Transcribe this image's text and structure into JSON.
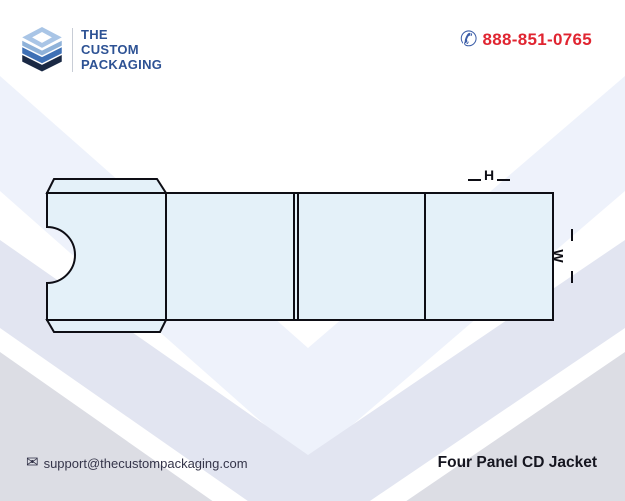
{
  "header": {
    "logo": {
      "lines": [
        "THE",
        "CUSTOM",
        "PACKAGING"
      ]
    },
    "phone": {
      "icon": "✆",
      "number": "888-851-0765"
    }
  },
  "diagram": {
    "height_label": "H",
    "width_label": "W"
  },
  "footer": {
    "email": {
      "icon": "✉",
      "address": "support@thecustompackaging.com"
    },
    "title": "Four Panel CD Jacket"
  },
  "colors": {
    "accent_red": "#e02531",
    "brand_navy": "#2d5294",
    "phone_icon_blue": "#3c5ea8",
    "panel_fill": "#e4f1f9",
    "outline_black": "#0e0e15",
    "band_light_blue": "#eef2fb",
    "band_lavender": "#e2e5f1",
    "band_gray": "#dcdde4"
  }
}
